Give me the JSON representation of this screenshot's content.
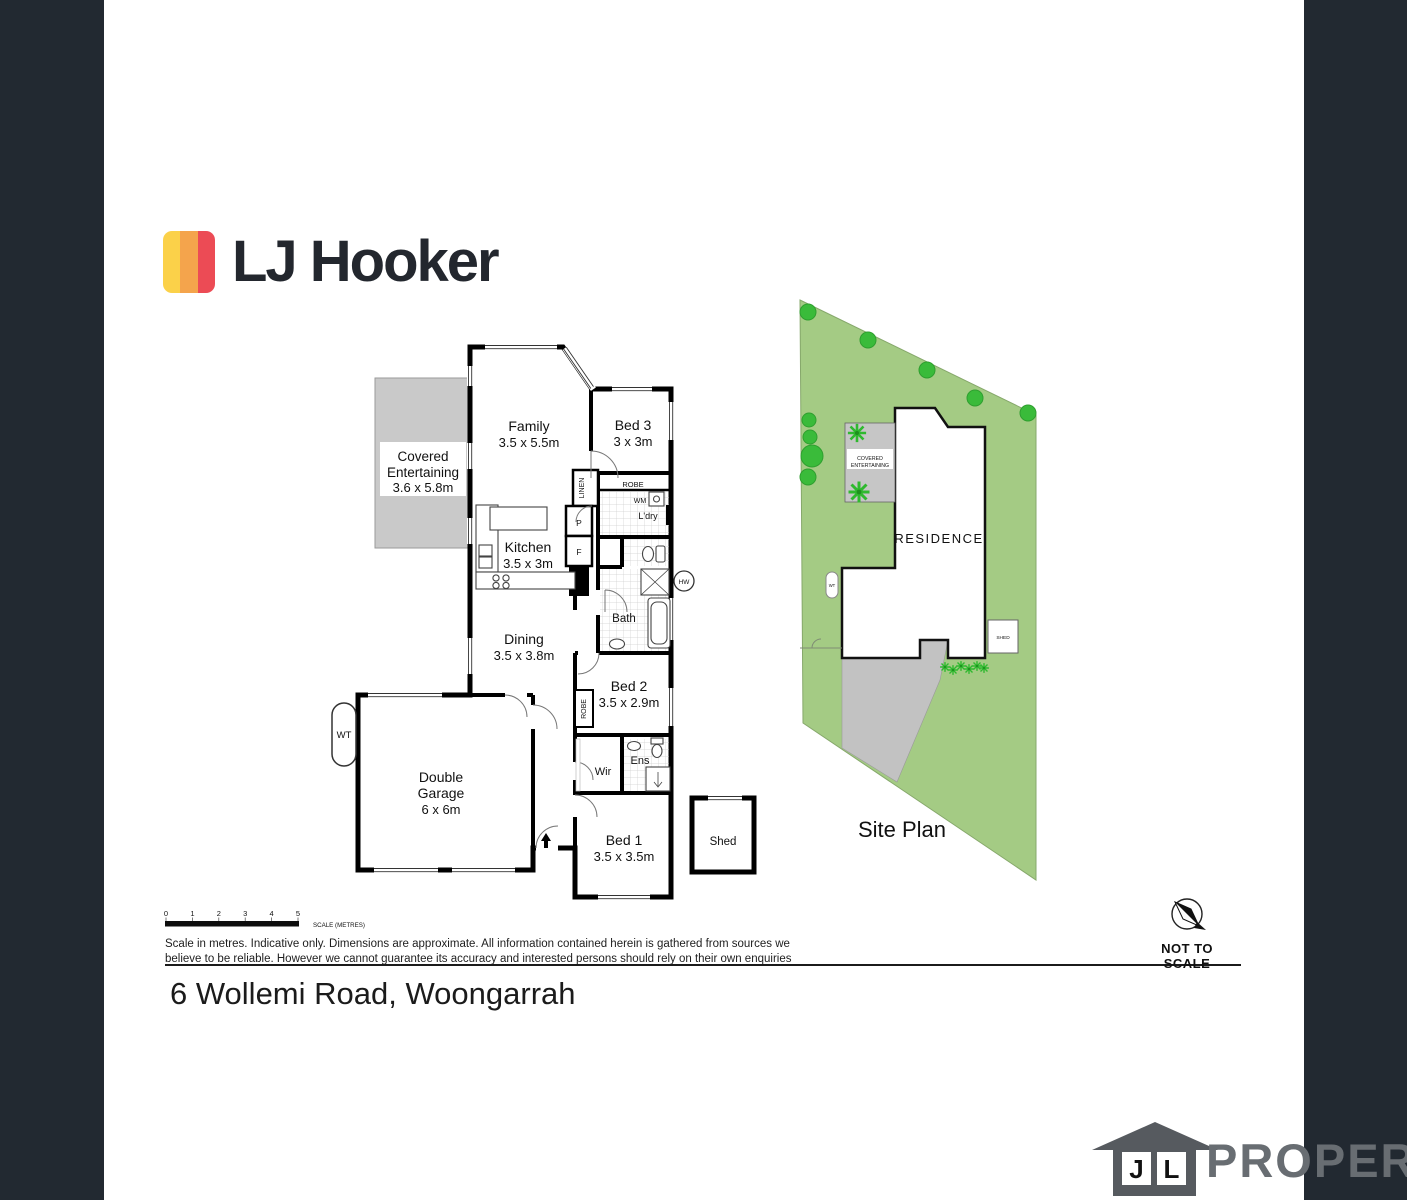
{
  "brand": {
    "logo_text": "LJ Hooker"
  },
  "floorplan": {
    "family_name": "Family",
    "family_dim": "3.5 x 5.5m",
    "bed3_name": "Bed 3",
    "bed3_dim": "3 x 3m",
    "covered_l1": "Covered",
    "covered_l2": "Entertaining",
    "covered_dim": "3.6 x 5.8m",
    "kitchen_name": "Kitchen",
    "kitchen_dim": "3.5 x 3m",
    "dining_name": "Dining",
    "dining_dim": "3.5 x 3.8m",
    "bed2_name": "Bed 2",
    "bed2_dim": "3.5 x 2.9m",
    "bed1_name": "Bed 1",
    "bed1_dim": "3.5 x 3.5m",
    "garage_l1": "Double",
    "garage_l2": "Garage",
    "garage_dim": "6 x 6m",
    "bath": "Bath",
    "ldry": "L'dry",
    "wm": "WM",
    "robe_bed3": "ROBE",
    "robe_bed2": "ROBE",
    "linen": "LINEN",
    "pantry": "P",
    "fridge": "F",
    "hw": "HW",
    "wir": "Wir",
    "ens": "Ens",
    "shed": "Shed",
    "wt": "WT"
  },
  "siteplan": {
    "residence": "RESIDENCE",
    "covered_l1": "COVERED",
    "covered_l2": "ENTERTAINING",
    "wt": "WT",
    "shed": "SHED",
    "title": "Site Plan"
  },
  "scalebar": {
    "ticks": [
      "0",
      "1",
      "2",
      "3",
      "4",
      "5"
    ],
    "label": "SCALE (METRES)"
  },
  "disclaimer": {
    "line1": "Scale in metres. Indicative only. Dimensions are approximate. All information contained herein is gathered from sources we",
    "line2": "believe to be reliable. However we cannot guarantee its accuracy and interested persons should rely on their own enquiries"
  },
  "compass": {
    "label": "NOT TO SCALE"
  },
  "address": "6 Wollemi Road, Woongarrah",
  "watermark": {
    "j": "J",
    "l": "L",
    "property": "PROPERTY"
  },
  "colors": {
    "brand_yellow": "#FBD149",
    "brand_orange": "#F4A44C",
    "brand_red": "#EC4B55",
    "side_bar": "#222931",
    "lot_green": "#A4CB84",
    "tree_green": "#3ABB3A",
    "driveway_gray": "#C2C2C2",
    "plan_gray": "#C9C9C9",
    "watermark_gray": "#565A5F"
  }
}
